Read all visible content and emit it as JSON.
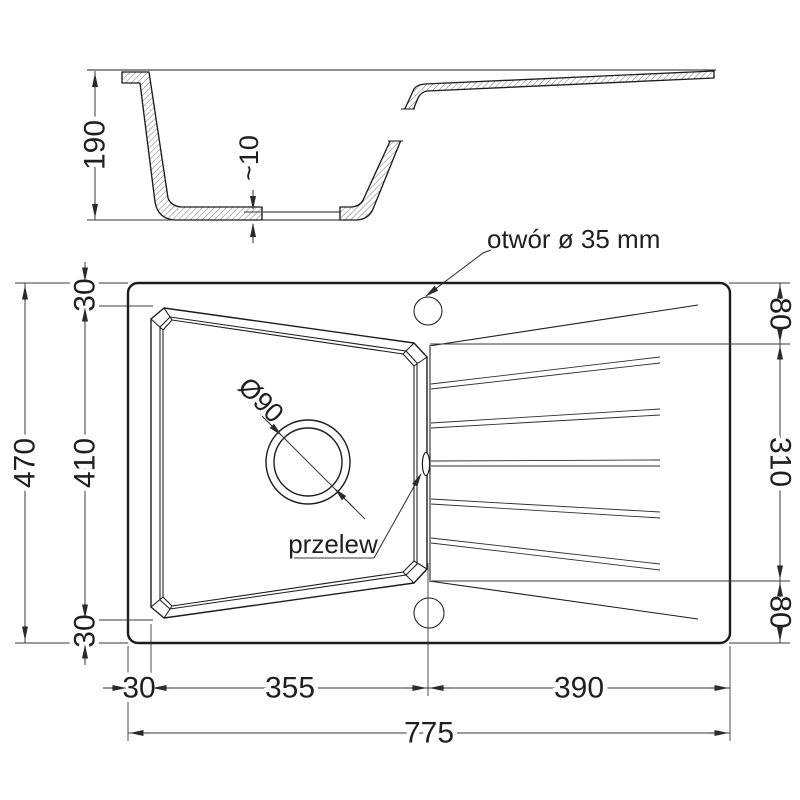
{
  "drawing": {
    "background": "#ffffff",
    "line_color": "#1c1c1c",
    "dimension_color": "#3a3a3a"
  },
  "section_view": {
    "height_dim": "190",
    "bottom_gap_dim": "~10"
  },
  "plan_view": {
    "left": {
      "total_height": "470",
      "top_rim": "30",
      "bowl_height": "410",
      "bottom_rim": "30"
    },
    "right": {
      "top_offset": "80",
      "bowl_right_span": "310",
      "bottom_offset": "80"
    },
    "bottom": {
      "left_rim": "30",
      "bowl_width": "355",
      "drainer_width": "390",
      "total_width": "775"
    },
    "annotations": {
      "tap_hole": "otwór ø 35 mm",
      "overflow": "przelew",
      "drain_diameter": "Ø90"
    }
  }
}
